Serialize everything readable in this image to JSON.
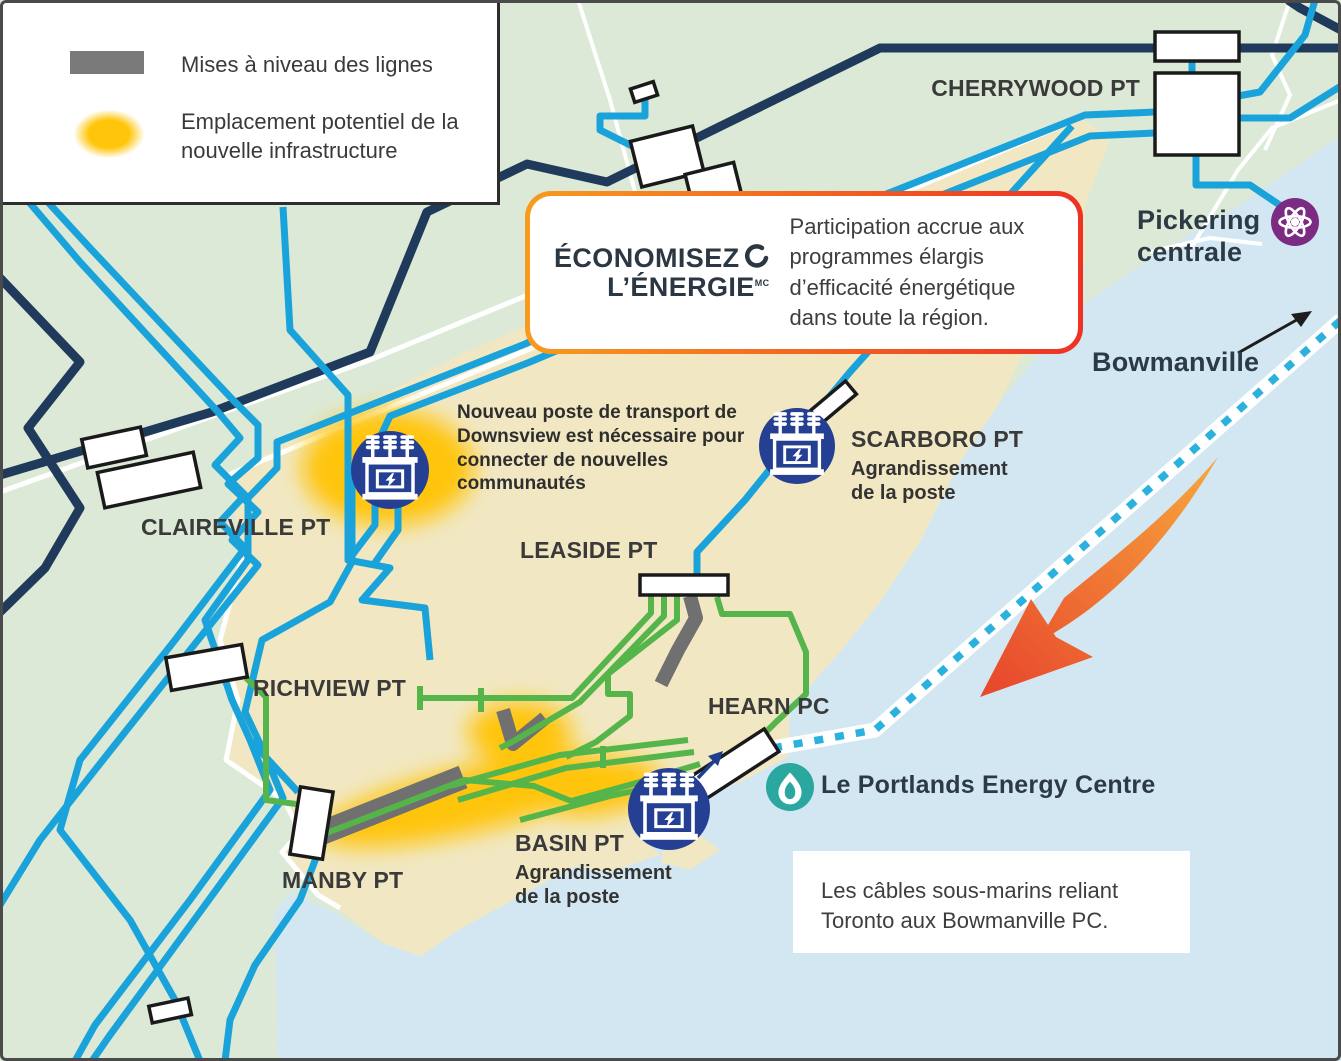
{
  "legend": {
    "items": [
      {
        "id": "line-upgrades",
        "swatch": "gray-bar",
        "label": "Mises à niveau des lignes"
      },
      {
        "id": "new-infrastructure",
        "swatch": "yellow-glow-blob",
        "label": "Emplacement potentiel de la nouvelle infrastructure"
      }
    ]
  },
  "callout": {
    "logo_line1": "ÉCONOMISEZ",
    "logo_line2": "L’ÉNERGIE",
    "logo_tm": "MC",
    "logo_icon": "loop-swirl-icon",
    "text": "Participation accrue aux programmes élargis d’efficacité énergétique dans toute la région."
  },
  "map": {
    "cherrywood": "CHERRYWOOD PT",
    "pickering": "Pickering centrale",
    "bowmanville": "Bowmanville",
    "claireville": "CLAIREVILLE PT",
    "leaside": "LEASIDE PT",
    "richview": "RICHVIEW PT",
    "manby": "MANBY PT",
    "hearn": "HEARN PC",
    "scarboro": {
      "title": "SCARBORO PT",
      "subtitle": "Agrandissement de la poste"
    },
    "basin": {
      "title": "BASIN PT",
      "subtitle": "Agrandissement de la poste"
    },
    "portlands": "Le Portlands Energy Centre",
    "notes": {
      "downsview": "Nouveau poste de transport de Downsview est nécessaire pour connecter de nouvelles communautés",
      "submarine": "Les câbles sous-marins reliant Toronto aux Bowmanville PC."
    }
  },
  "icons": {
    "substation": "transformer-substation-icon",
    "pickering_plant": "atom-icon",
    "portlands_plant": "flame-icon",
    "bowmanville_pointer": "arrow-northeast-icon",
    "lake_flow": "orange-swoosh-arrow",
    "submarine_cable": "dotted-cable-line",
    "basin_pointer": "arrow-northeast-icon"
  },
  "colors": {
    "background_green": "#dce9d6",
    "urban_beige": "#f1e8c3",
    "water_blue": "#d3e7f2",
    "transmission_blue": "#1aa3da",
    "transmission_navy": "#203a5c",
    "distribution_green": "#55b54b",
    "upgrade_gray": "#707070",
    "new_infra_yellow": "#ffc50a",
    "icon_blue": "#254093",
    "nuclear_purple": "#7b2b82",
    "gas_teal": "#2aa79e",
    "callout_orange": "#f79b1e",
    "callout_red": "#ee3124",
    "logo_navy": "#2b3844"
  }
}
